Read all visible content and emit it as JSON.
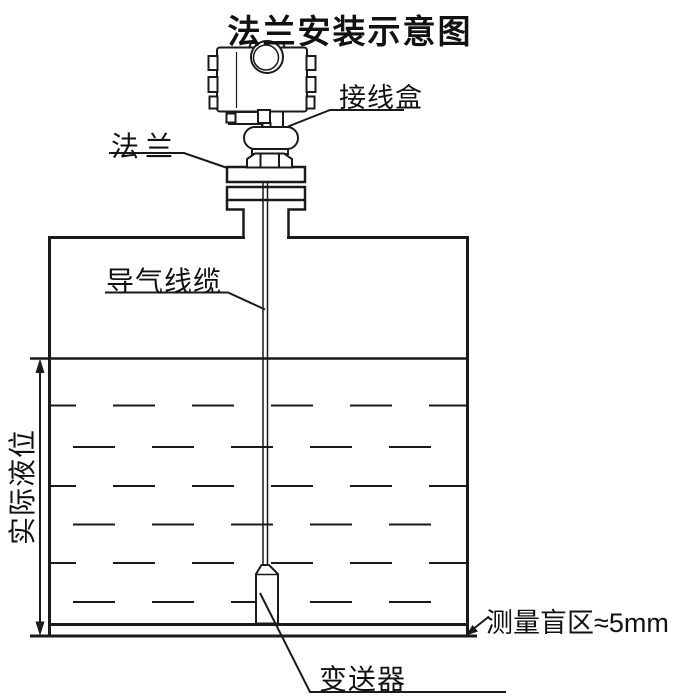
{
  "title": "法兰安装示意图",
  "labels": {
    "junction_box": "接线盒",
    "flange": "法兰",
    "air_cable": "导气线缆",
    "actual_level": "实际液位",
    "blind_zone": "测量盲区≈5mm",
    "transmitter": "变送器"
  },
  "colors": {
    "line": "#1a1a1a",
    "text": "#111111",
    "background": "#ffffff"
  }
}
